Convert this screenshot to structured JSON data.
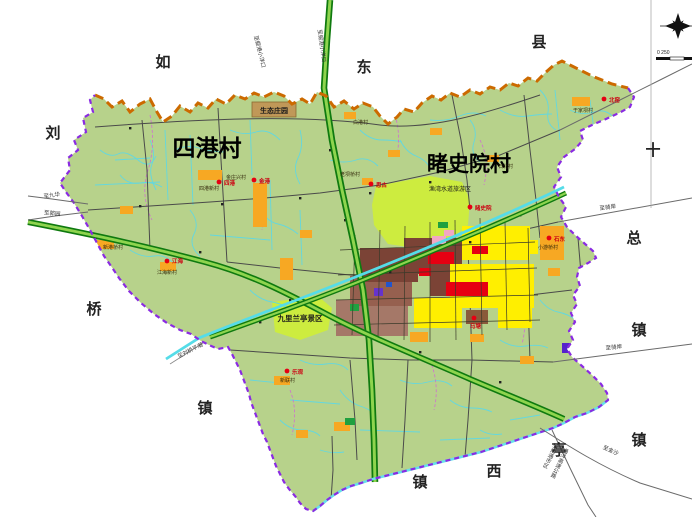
{
  "map_labels": {
    "village_sigang": "四港村",
    "village_dushiyuan": "睹史院村"
  },
  "adjacent_regions": {
    "top": [
      "如",
      "东",
      "县"
    ],
    "left": [
      "刘",
      "桥",
      "镇"
    ],
    "right": [
      "十",
      "总",
      "镇"
    ],
    "bottom": [
      "镇",
      "西",
      "亭",
      "镇"
    ]
  },
  "zones": {
    "eco_manor": "生态庄园",
    "lanting_scenic": "九里兰亭景区",
    "yuwan_scenic": "渔湾水道旅游区"
  },
  "settlements": [
    {
      "dot": "四港",
      "block": "四港新村"
    },
    {
      "dot": "金港",
      "block": "金庄兴村"
    },
    {
      "dot": "思古",
      "block": "老坝桥村"
    },
    {
      "dot": "睹史院",
      "block": ""
    },
    {
      "dot": "北窑",
      "block": "于家坝村"
    },
    {
      "dot": "石东",
      "block": "小游桥村"
    },
    {
      "dot": "马塘",
      "block": ""
    },
    {
      "dot": "乐观",
      "block": "新联村"
    },
    {
      "dot": "江海",
      "block": "江海新村"
    }
  ],
  "village_names": [
    "新港桥村",
    "白港村",
    "石北村"
  ],
  "road_labels": {
    "top_left": "至掘港小洋口",
    "top_right": "至掘港小洋口",
    "west_upper": "至九华",
    "west_lower": "至郭园",
    "east_upper": "至骑岸",
    "east_lower": "至骑岸",
    "southeast_jinsha": "至金沙",
    "south_city": "至南通市区",
    "south_expwy": "通洋高速公路",
    "southwest_canal": "至刘桥平潮"
  },
  "scale_bar": {
    "labels": "0 250"
  },
  "compass": {
    "icon": "north-arrow"
  },
  "colors": {
    "land": "#b7d28b",
    "scenic_zone": "#cdec3f",
    "settlement_block": "#f7a823",
    "urban_brown": "#7b4336",
    "urban_tan": "#a57868",
    "urban_yellow": "#ffef00",
    "urban_red": "#e60012",
    "water": "#5fd8e4",
    "expressway_green": "#0f7a0f",
    "north_boundary": "#cc6a00",
    "boundary_purple": "#8a2be2"
  }
}
